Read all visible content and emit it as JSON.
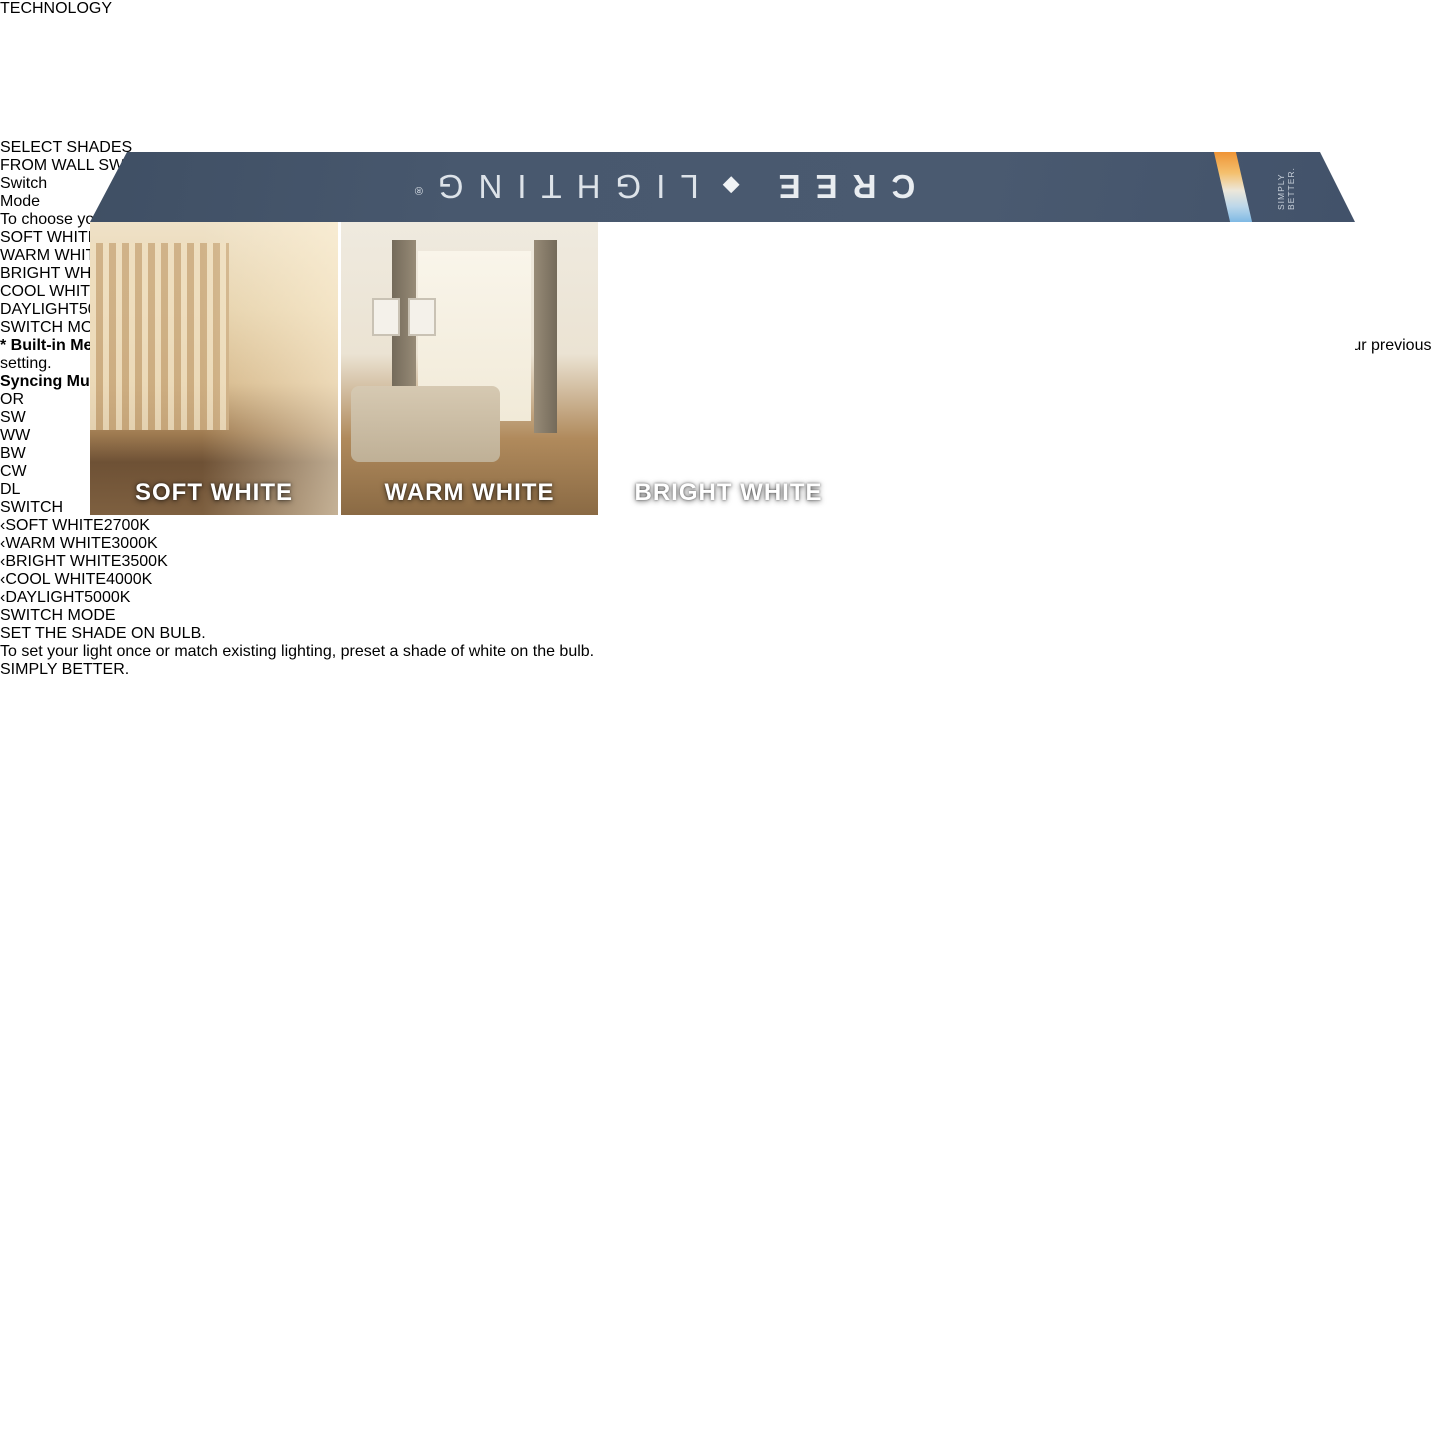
{
  "colors": {
    "blue_section": "#0e5da0",
    "navy": "#14253e",
    "flap_slate": "#46566c",
    "light_bg": "#e8e8ea",
    "soft_white": "#ee7e23",
    "warm_white": "#f6ca41",
    "bright_white": "#d5d5d3",
    "cool_white": "#c4e0ec",
    "daylight": "#4496e0"
  },
  "icons": {
    "chevron_left": "‹",
    "chevron_right": "›",
    "diamond": "◆"
  },
  "top_flap": {
    "brand_left": "CREE",
    "brand_right": "LIGHTING",
    "registered": "®",
    "edge_text": "SIMPLY BETTER."
  },
  "badge": {
    "label": "TECHNOLOGY"
  },
  "panels": [
    {
      "label": "SOFT WHITE"
    },
    {
      "label": "WARM WHITE"
    },
    {
      "label": "BRIGHT WHITE"
    },
    {
      "label": "COOL WHITE"
    },
    {
      "label": "DAYLIGHT"
    }
  ],
  "switch_section": {
    "heading_line1": "SELECT SHADES",
    "heading_line2": "FROM WALL SWITCH.",
    "logo": {
      "word1": "Switch",
      "word2": "Mode"
    },
    "body": {
      "pre": "To choose your shade of white in the moment, set to ",
      "bold": "SWITCH MODE",
      "post": " and toggle from warm to cool lighting by using your existing wall switch or dimmer.*"
    },
    "shades": [
      {
        "name": "SOFT WHITE",
        "kelvin": "2700K"
      },
      {
        "name": "WARM WHITE",
        "kelvin": "3000K"
      },
      {
        "name": "BRIGHT WHITE",
        "kelvin": "3500K"
      },
      {
        "name": "COOL WHITE",
        "kelvin": "4000K"
      },
      {
        "name": "DAYLIGHT",
        "kelvin": "5000K"
      }
    ],
    "switch_mode_row": "SWITCH MODE (SM)",
    "footnotes": [
      {
        "bold": "* Built-in Memory -",
        "text": " Switch Mode remembers your last setting. Flip to your preferred color temperature and leave the bulb off for 5 seconds. When you turn the light on again, it will return to your previous setting."
      },
      {
        "bold": "Syncing Multiple Lights in Switch Mode -",
        "text": " Toggle the switch ON/OFF 7 times to reset all bulbs to Soft White."
      }
    ]
  },
  "or_label": "OR",
  "bulb_section": {
    "heading": "SET THE SHADE ON BULB.",
    "body": "To set your light once or match existing lighting, preset a shade of white on the bulb.",
    "legend": [
      {
        "abbr": "SW"
      },
      {
        "abbr": "WW"
      },
      {
        "abbr": "BW"
      },
      {
        "abbr": "CW"
      },
      {
        "abbr": "DL"
      },
      {
        "abbr": "SWITCH"
      }
    ],
    "switch_mode_label": "SWITCH MODE"
  },
  "footer": {
    "tagline": "SIMPLY BETTER."
  }
}
